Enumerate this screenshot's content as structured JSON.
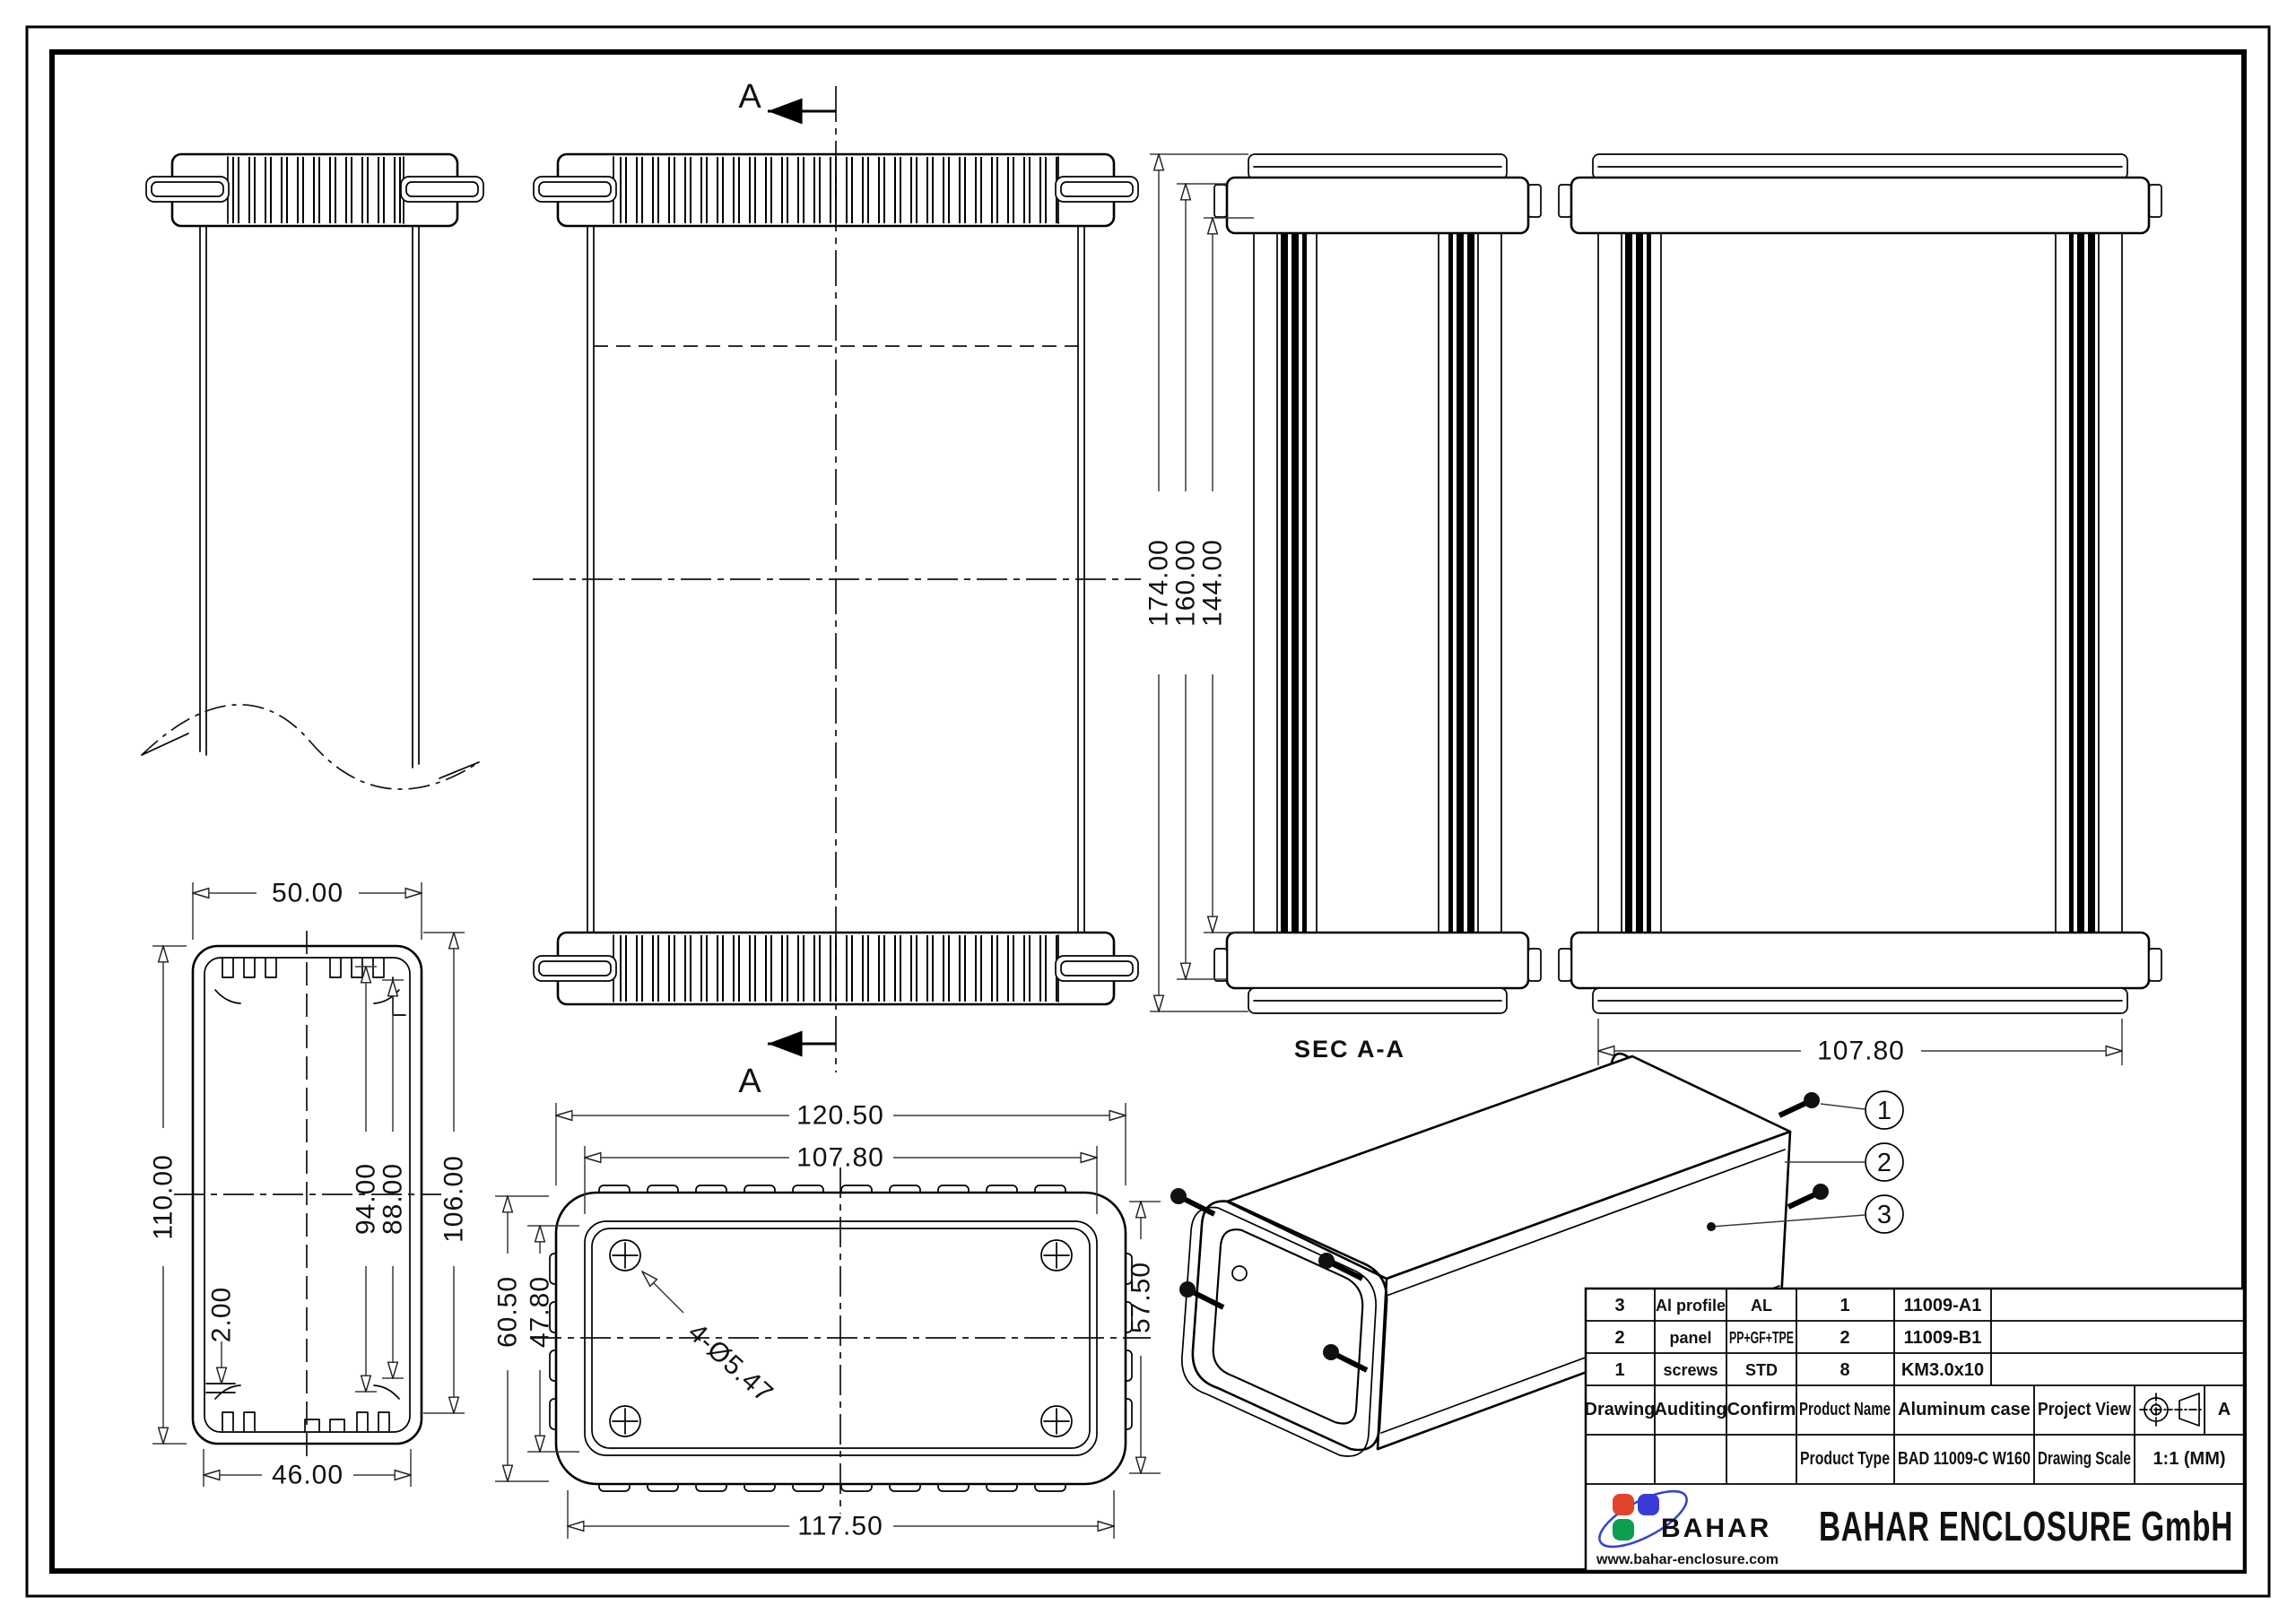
{
  "drawing": {
    "section_marks": {
      "top": "A",
      "bottom": "A"
    },
    "sec_view": {
      "title": "SEC  A-A",
      "dim_total": "174.00",
      "dim_mid": "160.00",
      "dim_inner": "144.00"
    },
    "rear_view": {
      "dim_width": "107.80"
    },
    "profile_view": {
      "dim_width": "50.00",
      "dim_height": "110.00",
      "dim_slot_a": "94.00",
      "dim_slot_b": "88.00",
      "dim_inner_h": "106.00",
      "dim_wall": "2.00",
      "dim_bottom_w": "46.00"
    },
    "panel_view": {
      "dim_outer_w": "120.50",
      "dim_panel_w": "107.80",
      "dim_body_w": "117.50",
      "dim_outer_h": "60.50",
      "dim_panel_h": "47.80",
      "dim_body_h": "57.50",
      "dim_holes": "4-Ø5.47"
    },
    "balloons": [
      "1",
      "2",
      "3"
    ]
  },
  "title_block": {
    "bom": [
      {
        "pos": "3",
        "part": "Al profile",
        "material": "AL",
        "qty": "1",
        "code": "11009-A1"
      },
      {
        "pos": "2",
        "part": "panel",
        "material": "PP+GF+TPE",
        "qty": "2",
        "code": "11009-B1"
      },
      {
        "pos": "1",
        "part": "screws",
        "material": "STD",
        "qty": "8",
        "code": "KM3.0x10"
      }
    ],
    "labels": {
      "drawing": "Drawing",
      "auditing": "Auditing",
      "confirm": "Confirm",
      "product_name": "Product Name",
      "product_type": "Product Type",
      "project_view": "Project View",
      "drawing_scale": "Drawing Scale"
    },
    "values": {
      "product_name": "Aluminum case",
      "product_type": "BAD 11009-C W160",
      "view_letter": "A",
      "scale": "1:1 (MM)"
    },
    "company": {
      "name": "BAHAR ENCLOSURE GmbH",
      "logo_text": "BAHAR",
      "website": "www.bahar-enclosure.com"
    },
    "colors": {
      "logo_red": "#e2442a",
      "logo_blue": "#3b3bd8",
      "logo_green": "#0f9d4f",
      "logo_orbit": "#3344cc",
      "line": "#000000",
      "dim": "#3a3a3a"
    }
  }
}
